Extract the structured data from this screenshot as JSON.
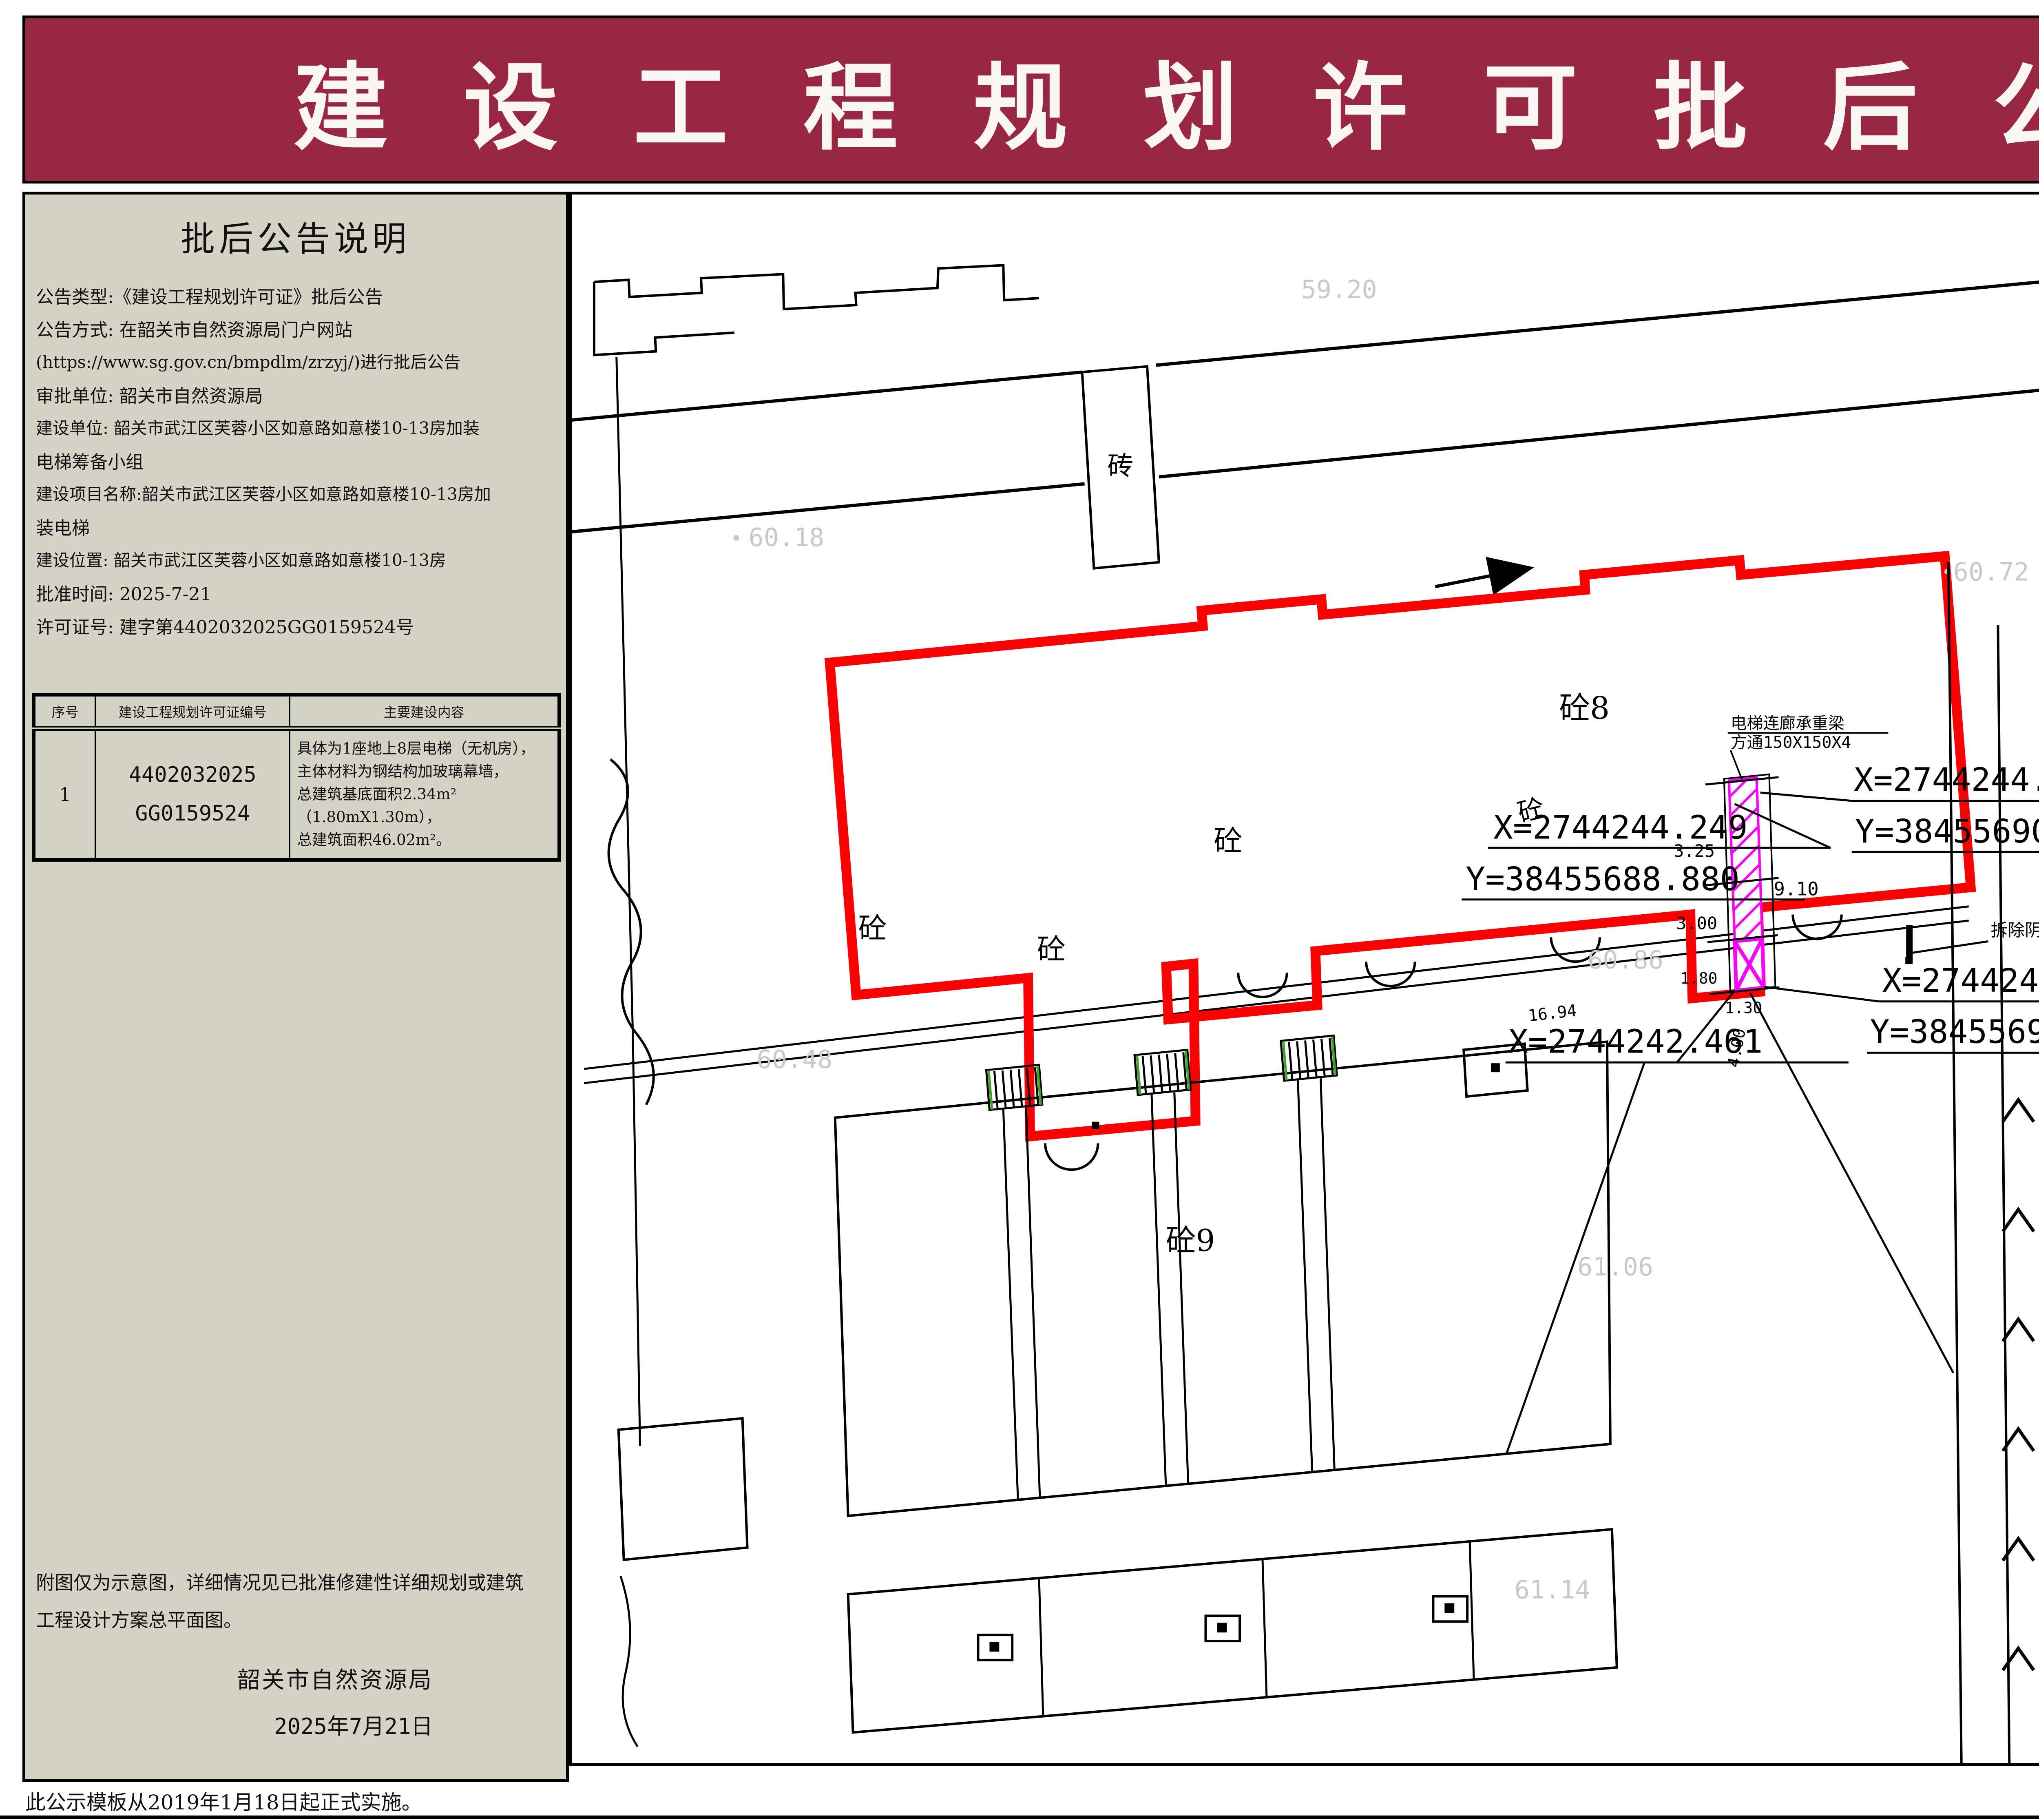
{
  "header": {
    "title": "建 设 工 程 规 划 许 可 批 后 公 告"
  },
  "left_panel": {
    "title": "批后公告说明",
    "lines": [
      "公告类型:《建设工程规划许可证》批后公告",
      "公告方式: 在韶关市自然资源局门户网站",
      "(https://www.sg.gov.cn/bmpdlm/zrzyj/)进行批后公告",
      "审批单位: 韶关市自然资源局",
      "建设单位: 韶关市武江区芙蓉小区如意路如意楼10-13房加装",
      "电梯筹备小组",
      "建设项目名称:韶关市武江区芙蓉小区如意路如意楼10-13房加",
      "装电梯",
      "建设位置: 韶关市武江区芙蓉小区如意路如意楼10-13房",
      "批准时间: 2025-7-21",
      "许可证号: 建字第4402032025GG0159524号"
    ],
    "table": {
      "headers": [
        "序号",
        "建设工程规划许可证编号",
        "主要建设内容"
      ],
      "row": {
        "no": "1",
        "permit_line1": "4402032025",
        "permit_line2": "GG0159524",
        "content_lines": [
          "具体为1座地上8层电梯（无机房），",
          "主体材料为钢结构加玻璃幕墙，",
          "总建筑基底面积2.34m²（1.80mX1.30m），",
          "总建筑面积46.02m²。"
        ]
      }
    },
    "notes": [
      "附图仅为示意图，详细情况见已批准修建性详细规划或建筑",
      "工程设计方案总平面图。"
    ],
    "signature": "韶关市自然资源局",
    "date": "2025年7月21日"
  },
  "plan": {
    "labels": {
      "b8": "砼8",
      "b9": "砼9",
      "brick": "砖",
      "t1": "砼",
      "t2": "砼",
      "t3": "砼",
      "t4": "砼",
      "t5": "砼"
    },
    "elevations": {
      "e1": "59.20",
      "e2": "60.18",
      "e3": "60.72",
      "e4": "60.48",
      "e5": "60.86",
      "e6": "61.06",
      "e7": "61.14"
    },
    "coordinates": {
      "c1x": "X=2744244.249",
      "c1y": "Y=38455688.880",
      "c2x": "X=2744244.398",
      "c2y": "Y=38455690.171",
      "c3x": "X=2744242.610",
      "c3y": "Y=38455690.378",
      "c4x": "X=2744242.461"
    },
    "annotations": {
      "beam_line1": "电梯连廊承重梁",
      "beam_line2": "方通150X150X4",
      "demolish": "拆除阴影部分现有围墙"
    },
    "dimensions": {
      "d1": "3.25",
      "d2": "9.10",
      "d3": "3.00",
      "d4": "1.80",
      "d5": "1.30",
      "d6": "4.00",
      "d7": "16.94"
    }
  },
  "right_panel": {
    "compass_label": "N",
    "legend": {
      "title": "图 例",
      "items": [
        {
          "label": "新建电梯主体"
        },
        {
          "label": "新建电梯所占用地"
        },
        {
          "label": "新建电梯所在建筑"
        },
        {
          "label": "尺 寸 标 注",
          "sample": "2.35"
        },
        {
          "label": "坐 标 标 注",
          "sample_x": "X=43337.034",
          "sample_y": "Y=58209.521"
        }
      ]
    },
    "location_title": "项目位置示意:",
    "map": {
      "labels": [
        {
          "t": "商务酒店",
          "x": 40,
          "y": 3,
          "c": ""
        },
        {
          "t": "专业烫染店",
          "x": 63,
          "y": 3,
          "c": ""
        },
        {
          "t": "异源农产品",
          "x": 88,
          "y": 8,
          "c": ""
        },
        {
          "t": "华为合作店",
          "x": 10,
          "y": 13,
          "c": ""
        },
        {
          "t": "美宜佳",
          "x": 54,
          "y": 21,
          "c": ""
        },
        {
          "t": "工业中路辅路",
          "x": 79,
          "y": 17,
          "c": "road"
        },
        {
          "t": "知服24h无人",
          "x": 31,
          "y": 25,
          "c": ""
        },
        {
          "t": "定制服装店",
          "x": 31,
          "y": 30,
          "c": ""
        },
        {
          "t": "工业中路",
          "x": 55,
          "y": 30,
          "c": "road"
        },
        {
          "t": "入口",
          "x": 6,
          "y": 34,
          "c": "chip"
        },
        {
          "t": "入口",
          "x": 6,
          "y": 41,
          "c": "chip"
        },
        {
          "t": "叶源茶庄",
          "x": 44,
          "y": 46,
          "c": ""
        },
        {
          "t": "诺仕明",
          "x": 96,
          "y": 42,
          "c": ""
        },
        {
          "t": "中国移动",
          "x": 74,
          "y": 45,
          "c": ""
        },
        {
          "t": "9栋",
          "x": 63,
          "y": 46,
          "c": "bld"
        },
        {
          "t": "7橦",
          "x": 89,
          "y": 48,
          "c": "bld"
        },
        {
          "t": "苏七贸易商行",
          "x": 17,
          "y": 49,
          "c": ""
        },
        {
          "t": "19栋",
          "x": 36,
          "y": 48,
          "c": "bld"
        },
        {
          "t": "15栋",
          "x": 49,
          "y": 50,
          "c": "bld"
        },
        {
          "t": "13栋",
          "x": 58,
          "y": 53,
          "c": "bld"
        },
        {
          "t": "17栋",
          "x": 48,
          "y": 56,
          "c": "bld"
        },
        {
          "t": "21栋",
          "x": 34,
          "y": 58,
          "c": "bld"
        },
        {
          "t": "25栋",
          "x": 25,
          "y": 59,
          "c": "bld"
        },
        {
          "t": "项目位置",
          "x": 71,
          "y": 55,
          "c": "red"
        },
        {
          "t": "工业西新村",
          "x": 13,
          "y": 55,
          "c": "area"
        },
        {
          "t": "31栋",
          "x": 3,
          "y": 60,
          "c": "bld"
        },
        {
          "t": "如意路",
          "x": 38,
          "y": 66,
          "c": "road rot"
        },
        {
          "t": "意君康保健",
          "x": 64,
          "y": 62,
          "c": ""
        },
        {
          "t": "心缘美容养生馆",
          "x": 78,
          "y": 66,
          "c": ""
        },
        {
          "t": "慧卿初中托",
          "x": 32,
          "y": 70,
          "c": ""
        },
        {
          "t": "微你商行",
          "x": 51,
          "y": 70,
          "c": ""
        },
        {
          "t": "凤香茶庄",
          "x": 4,
          "y": 73,
          "c": ""
        },
        {
          "t": "宜嘉商行",
          "x": 14,
          "y": 74,
          "c": ""
        },
        {
          "t": "如意楼C座",
          "x": 29,
          "y": 76,
          "c": "bld"
        },
        {
          "t": "新金中",
          "x": 37,
          "y": 80,
          "c": ""
        },
        {
          "t": "转角养生阁",
          "x": 50,
          "y": 78,
          "c": ""
        },
        {
          "t": "A栋",
          "x": 63,
          "y": 75,
          "c": "bld"
        },
        {
          "t": "静静保",
          "x": 94,
          "y": 73,
          "c": ""
        },
        {
          "t": "金芙蓉大厦",
          "x": 86,
          "y": 76,
          "c": ""
        },
        {
          "t": "嘉丰苑",
          "x": 67,
          "y": 81,
          "c": ""
        },
        {
          "t": "D栋",
          "x": 33,
          "y": 84,
          "c": "bld"
        },
        {
          "t": "德风托管",
          "x": 22,
          "y": 85,
          "c": ""
        },
        {
          "t": "型剪美发",
          "x": 60,
          "y": 86,
          "c": ""
        },
        {
          "t": "B栋",
          "x": 65,
          "y": 84,
          "c": "bld"
        },
        {
          "t": "A幢",
          "x": 94,
          "y": 84,
          "c": "bld"
        },
        {
          "t": "C栋",
          "x": 34,
          "y": 90,
          "c": "bld"
        },
        {
          "t": "山水华府幼儿园",
          "x": 61,
          "y": 90,
          "c": ""
        },
        {
          "t": "金芙蓉花园",
          "x": 87,
          "y": 90,
          "c": ""
        },
        {
          "t": "金芙",
          "x": 97,
          "y": 87,
          "c": ""
        },
        {
          "t": "金易集成吊顶",
          "x": 25,
          "y": 93,
          "c": ""
        },
        {
          "t": "嘉盛苑",
          "x": 40,
          "y": 94,
          "c": ""
        },
        {
          "t": "B栋",
          "x": 67,
          "y": 95,
          "c": "bld"
        },
        {
          "t": "C幢",
          "x": 91,
          "y": 95,
          "c": "bld"
        },
        {
          "t": "武江区棋类协会",
          "x": 18,
          "y": 97,
          "c": ""
        },
        {
          "t": "武江区万佳生活坊",
          "x": 52,
          "y": 98,
          "c": ""
        },
        {
          "t": "嘉荣苑",
          "x": 70,
          "y": 97,
          "c": ""
        }
      ],
      "icons": [
        {
          "g": "bag",
          "col": "#F08F2F",
          "x": 6,
          "y": 9
        },
        {
          "g": "P",
          "col": "#4D92E2",
          "x": 49,
          "y": 4
        },
        {
          "g": "cart",
          "col": "#F08F2F",
          "x": 54,
          "y": 7
        },
        {
          "g": "scis",
          "col": "#9F5FD6",
          "x": 62,
          "y": 5
        },
        {
          "g": "bag",
          "col": "#F08F2F",
          "x": 87,
          "y": 6
        },
        {
          "g": "P",
          "col": "#4D92E2",
          "x": 10,
          "y": 22
        },
        {
          "g": "bag",
          "col": "#F08F2F",
          "x": 33,
          "y": 20
        },
        {
          "g": "bag",
          "col": "#F08F2F",
          "x": 48,
          "y": 45
        },
        {
          "g": "dot",
          "col": "#4D92E2",
          "x": 80,
          "y": 45
        },
        {
          "g": "dot",
          "col": "#4D92E2",
          "x": 64,
          "y": 55
        },
        {
          "g": "bag",
          "col": "#F08F2F",
          "x": 46,
          "y": 72
        },
        {
          "g": "scis",
          "col": "#9F5FD6",
          "x": 59,
          "y": 81
        },
        {
          "g": "m",
          "col": "#0FA79D",
          "x": 38,
          "y": 75
        },
        {
          "g": "m",
          "col": "#0FA79D",
          "x": 60,
          "y": 86
        },
        {
          "g": "home",
          "col": "#5C6BC0",
          "x": 88,
          "y": 73
        },
        {
          "g": "home",
          "col": "#5C6BC0",
          "x": 69,
          "y": 80
        },
        {
          "g": "dot",
          "col": "#4D92E2",
          "x": 78,
          "y": 64
        },
        {
          "g": "dot",
          "col": "#4D92E2",
          "x": 25,
          "y": 84
        },
        {
          "g": "bag",
          "col": "#F08F2F",
          "x": 24,
          "y": 95
        },
        {
          "g": "bag",
          "col": "#F08F2F",
          "x": 59,
          "y": 98
        },
        {
          "g": "home",
          "col": "#5C6BC0",
          "x": 67,
          "y": 94
        },
        {
          "g": "home",
          "col": "#5C6BC0",
          "x": 88,
          "y": 92
        },
        {
          "g": "dot",
          "col": "#4D92E2",
          "x": 4,
          "y": 79
        }
      ]
    }
  },
  "footer": {
    "left": "此公示模板从2019年1月18日起正式实施。",
    "right": "监制单位：韶关市自然资源局"
  }
}
